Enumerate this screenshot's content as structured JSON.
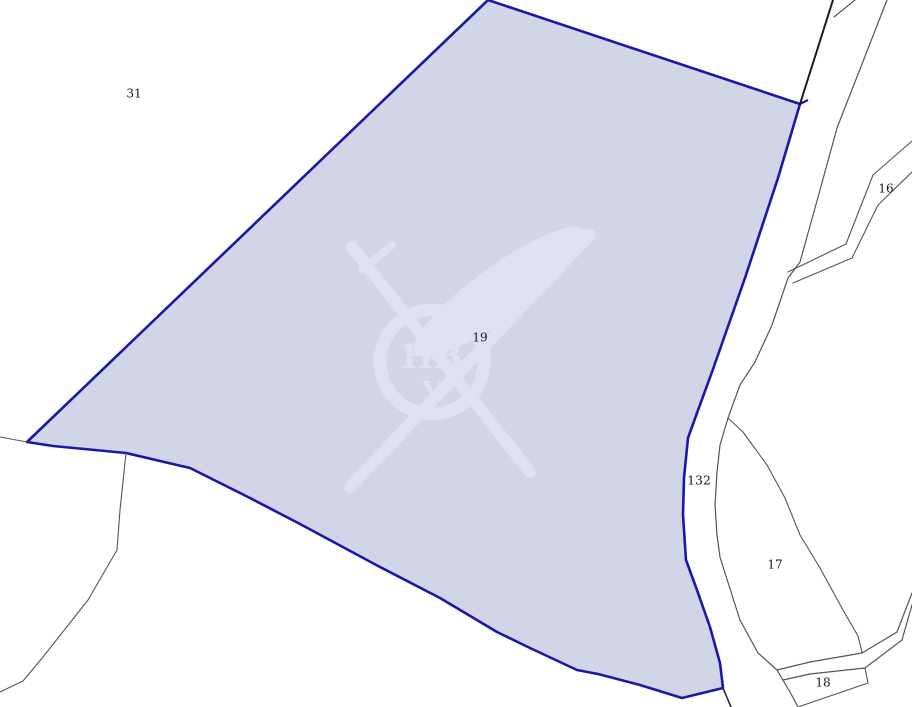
{
  "map": {
    "background": "#ffffff",
    "colors": {
      "parcel_fill": "#d2d4e8",
      "parcel_border": "#1b18a6",
      "boundary_line": "#555555",
      "dark_line": "#1c1c1c",
      "label_text": "#1a1a1a",
      "watermark": "#dee1f2"
    },
    "highlighted_parcel": {
      "id": "19",
      "polygon": [
        [
          488,
          0
        ],
        [
          800,
          104
        ],
        [
          778,
          178
        ],
        [
          745,
          278
        ],
        [
          712,
          372
        ],
        [
          697,
          413
        ],
        [
          688,
          438
        ],
        [
          684,
          478
        ],
        [
          683,
          515
        ],
        [
          686,
          560
        ],
        [
          697,
          590
        ],
        [
          710,
          627
        ],
        [
          720,
          663
        ],
        [
          723,
          688
        ],
        [
          682,
          698
        ],
        [
          640,
          685
        ],
        [
          598,
          674
        ],
        [
          577,
          670
        ],
        [
          530,
          648
        ],
        [
          497,
          632
        ],
        [
          440,
          598
        ],
        [
          380,
          567
        ],
        [
          300,
          524
        ],
        [
          248,
          497
        ],
        [
          190,
          468
        ],
        [
          126,
          453
        ],
        [
          53,
          446
        ],
        [
          27,
          442
        ]
      ],
      "border_width": 2.6,
      "spur": [
        [
          800,
          104
        ],
        [
          808,
          100
        ]
      ]
    },
    "labels": [
      {
        "name": "parcel-label-31",
        "text": "31",
        "x": 134,
        "y": 94,
        "size": 12
      },
      {
        "name": "parcel-label-19",
        "text": "19",
        "x": 480,
        "y": 338,
        "size": 12
      },
      {
        "name": "parcel-label-16",
        "text": "16",
        "x": 886,
        "y": 189,
        "size": 12
      },
      {
        "name": "parcel-label-132",
        "text": "132",
        "x": 699,
        "y": 481,
        "size": 12.5
      },
      {
        "name": "parcel-label-17",
        "text": "17",
        "x": 775,
        "y": 565,
        "size": 12
      },
      {
        "name": "parcel-label-18",
        "text": "18",
        "x": 823,
        "y": 683,
        "size": 12
      }
    ],
    "boundary_lines": [
      {
        "name": "edge-left-to-corner",
        "color": "#555555",
        "width": 1.1,
        "points": [
          [
            0,
            437
          ],
          [
            27,
            442
          ]
        ]
      },
      {
        "name": "divider-bottom-left",
        "color": "#555555",
        "width": 1.1,
        "points": [
          [
            126,
            453
          ],
          [
            120,
            510
          ],
          [
            117,
            550
          ],
          [
            88,
            600
          ],
          [
            43,
            657
          ],
          [
            23,
            681
          ],
          [
            0,
            692
          ]
        ]
      },
      {
        "name": "dark-line-top-right",
        "color": "#1c1c1c",
        "width": 2,
        "points": [
          [
            833,
            0
          ],
          [
            800,
            104
          ]
        ]
      },
      {
        "name": "sliver-line-top",
        "color": "#3a3a3a",
        "width": 1.1,
        "points": [
          [
            855,
            0
          ],
          [
            834,
            17
          ]
        ]
      },
      {
        "name": "main-road-line-right",
        "color": "#555555",
        "width": 1.2,
        "points": [
          [
            887,
            0
          ],
          [
            837,
            128
          ],
          [
            820,
            190
          ],
          [
            800,
            262
          ],
          [
            788,
            278
          ],
          [
            772,
            325
          ],
          [
            755,
            362
          ],
          [
            740,
            385
          ],
          [
            728,
            418
          ],
          [
            720,
            445
          ],
          [
            717,
            472
          ],
          [
            715,
            505
          ],
          [
            717,
            535
          ],
          [
            720,
            557
          ],
          [
            725,
            573
          ],
          [
            740,
            620
          ],
          [
            758,
            653
          ],
          [
            777,
            670
          ],
          [
            790,
            692
          ],
          [
            798,
            707
          ]
        ]
      },
      {
        "name": "road-16-upper",
        "color": "#555555",
        "width": 1.1,
        "points": [
          [
            788,
            272
          ],
          [
            846,
            244
          ],
          [
            873,
            175
          ],
          [
            912,
            141
          ]
        ]
      },
      {
        "name": "road-16-lower",
        "color": "#555555",
        "width": 1.1,
        "points": [
          [
            793,
            283
          ],
          [
            852,
            258
          ],
          [
            878,
            205
          ],
          [
            912,
            172
          ]
        ]
      },
      {
        "name": "parcel-17-curve",
        "color": "#555555",
        "width": 1.1,
        "points": [
          [
            728,
            418
          ],
          [
            743,
            432
          ],
          [
            767,
            465
          ],
          [
            785,
            498
          ],
          [
            800,
            535
          ],
          [
            820,
            568
          ],
          [
            843,
            610
          ],
          [
            858,
            636
          ],
          [
            862,
            652
          ]
        ]
      },
      {
        "name": "road-br-upper",
        "color": "#555555",
        "width": 1.2,
        "points": [
          [
            912,
            593
          ],
          [
            897,
            632
          ],
          [
            862,
            653
          ],
          [
            810,
            662
          ],
          [
            777,
            670
          ]
        ]
      },
      {
        "name": "road-br-lower",
        "color": "#555555",
        "width": 1.2,
        "points": [
          [
            912,
            605
          ],
          [
            902,
            640
          ],
          [
            865,
            668
          ],
          [
            810,
            674
          ],
          [
            783,
            680
          ]
        ]
      },
      {
        "name": "parcel-18-right-edge",
        "color": "#555555",
        "width": 1.1,
        "points": [
          [
            865,
            668
          ],
          [
            868,
            683
          ]
        ]
      },
      {
        "name": "parcel-18-bottom-edge",
        "color": "#555555",
        "width": 1.1,
        "points": [
          [
            868,
            683
          ],
          [
            798,
            707
          ]
        ]
      },
      {
        "name": "line-below-parcel-corner",
        "color": "#26263a",
        "width": 1.6,
        "points": [
          [
            723,
            688
          ],
          [
            731,
            707
          ]
        ]
      }
    ],
    "watermark": {
      "monogram_top": "НВ",
      "monogram_bottom": "У",
      "circle": {
        "cx": 432,
        "cy": 362,
        "r": 52,
        "stroke_width": 13
      },
      "shafts": [
        {
          "name": "sword-blade",
          "x1": 352,
          "y1": 247,
          "x2": 530,
          "y2": 472,
          "width": 12
        },
        {
          "name": "paddle-shaft",
          "x1": 350,
          "y1": 487,
          "x2": 590,
          "y2": 235,
          "width": 12
        },
        {
          "name": "sword-hilt",
          "x1": 362,
          "y1": 270,
          "x2": 392,
          "y2": 245,
          "width": 8
        }
      ],
      "paddle_blade": {
        "cx": 500,
        "cy": 292,
        "rx": 105,
        "ry": 26,
        "rotate": -36
      }
    }
  }
}
